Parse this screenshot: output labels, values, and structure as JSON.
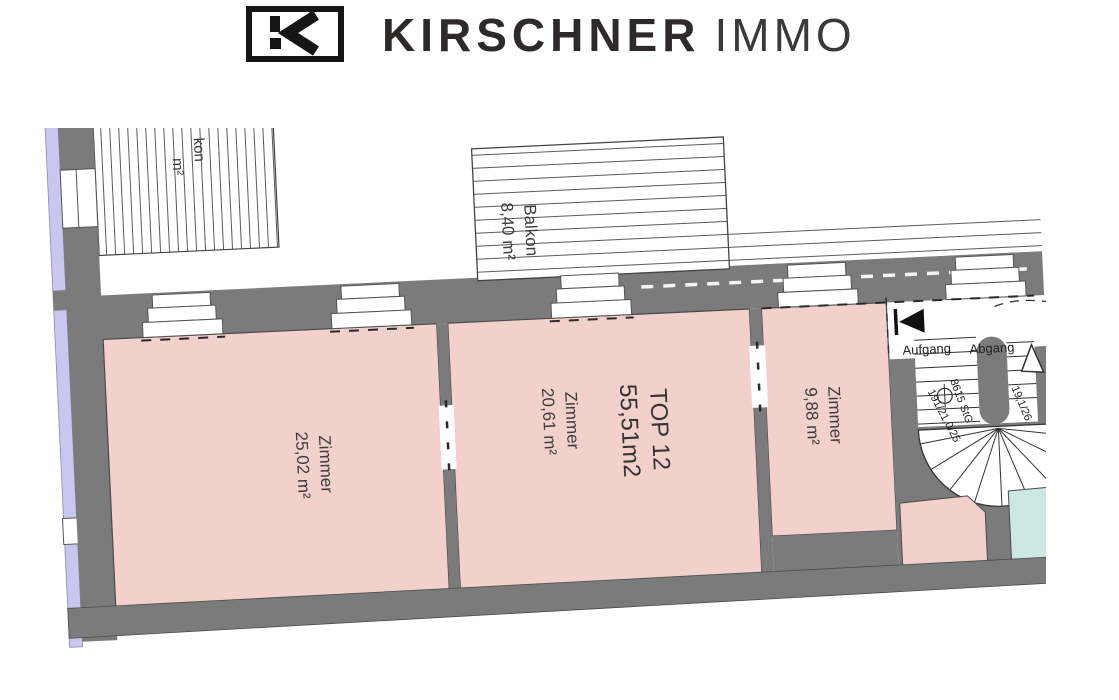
{
  "header": {
    "logo_icon": "kirschner-k-mark",
    "brand": "KIRSCHNER",
    "brand_suffix": "IMMO"
  },
  "plan": {
    "unit": {
      "line1": "TOP 12",
      "line2": "55,51m2"
    },
    "rooms": [
      {
        "name": "Zimmer",
        "area": "25,02 m²"
      },
      {
        "name": "Zimmer",
        "area": "20,61 m²"
      },
      {
        "name": "Zimmer",
        "area": "9,88 m²"
      }
    ],
    "balcony": {
      "name": "Balkon",
      "area": "8,40 m²"
    },
    "balcony_partial": {
      "name_fragment": "kon",
      "area_fragment": "m²"
    },
    "stair": {
      "up_label": "Aufgang",
      "up_spec": "191/21,0/25",
      "up_spec_2": "8615 StG",
      "down_label": "Abgang",
      "down_spec": "19,1/26"
    },
    "colors": {
      "room": "#f2d0cc",
      "wall": "#7b7b7b",
      "neighbor_room": "#cde8e3",
      "edge_strip": "#c7c7ef"
    }
  }
}
